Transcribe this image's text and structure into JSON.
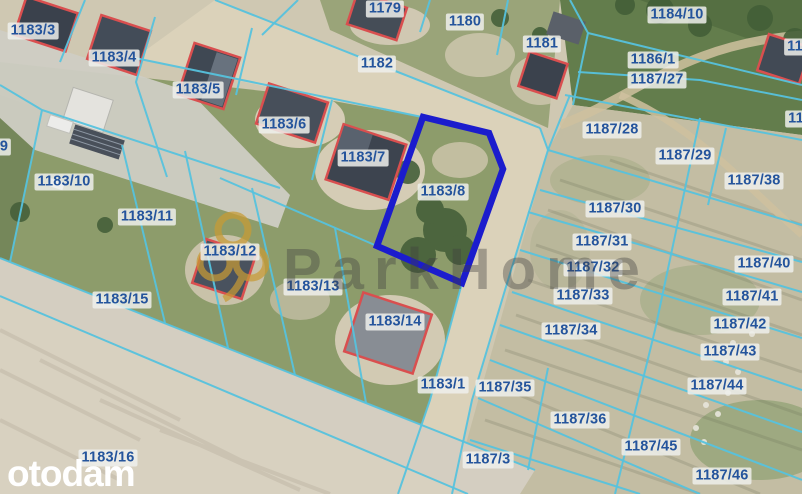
{
  "map": {
    "highlighted_parcel": "1183/8",
    "watermark": {
      "text": "ParkHome",
      "icon": "clover-rings-icon"
    },
    "brand_logo": "otodam",
    "colors": {
      "label_text": "#24549c",
      "boundary": "#56c2dd",
      "highlight": "#1b1ccd",
      "building_outline": "#d94f4f",
      "watermark_gold": "#c89b35",
      "watermark_text": "#3f3f3f",
      "logo_text": "#ffffff"
    },
    "parcel_labels": [
      {
        "text": "1183/3",
        "x": 33,
        "y": 31
      },
      {
        "text": "1183/4",
        "x": 114,
        "y": 58
      },
      {
        "text": "1183/5",
        "x": 198,
        "y": 90
      },
      {
        "text": "1179",
        "x": 385,
        "y": 9
      },
      {
        "text": "1180",
        "x": 465,
        "y": 22
      },
      {
        "text": "1182",
        "x": 377,
        "y": 64
      },
      {
        "text": "1181",
        "x": 542,
        "y": 44
      },
      {
        "text": "1183/6",
        "x": 284,
        "y": 125
      },
      {
        "text": "1183/7",
        "x": 363,
        "y": 158
      },
      {
        "text": "1183/8",
        "x": 443,
        "y": 192
      },
      {
        "text": "1184/10",
        "x": 677,
        "y": 15
      },
      {
        "text": "1186/1",
        "x": 653,
        "y": 60
      },
      {
        "text": "1187/27",
        "x": 657,
        "y": 80
      },
      {
        "text": "1187/28",
        "x": 612,
        "y": 130
      },
      {
        "text": "1187/29",
        "x": 685,
        "y": 156
      },
      {
        "text": "1187/38",
        "x": 754,
        "y": 181
      },
      {
        "text": "1187/30",
        "x": 615,
        "y": 209
      },
      {
        "text": "1187/31",
        "x": 602,
        "y": 242
      },
      {
        "text": "1187/32",
        "x": 593,
        "y": 268
      },
      {
        "text": "1187/33",
        "x": 583,
        "y": 296
      },
      {
        "text": "1187/40",
        "x": 764,
        "y": 264
      },
      {
        "text": "1187/41",
        "x": 752,
        "y": 297
      },
      {
        "text": "1187/42",
        "x": 740,
        "y": 325
      },
      {
        "text": "1187/34",
        "x": 571,
        "y": 331
      },
      {
        "text": "1187/43",
        "x": 730,
        "y": 352
      },
      {
        "text": "1187/44",
        "x": 717,
        "y": 386
      },
      {
        "text": "1187/36",
        "x": 580,
        "y": 420
      },
      {
        "text": "1187/45",
        "x": 651,
        "y": 447
      },
      {
        "text": "1187/46",
        "x": 722,
        "y": 476
      },
      {
        "text": "1187/35",
        "x": 505,
        "y": 388
      },
      {
        "text": "1183/1",
        "x": 443,
        "y": 385
      },
      {
        "text": "1187/3",
        "x": 488,
        "y": 460
      },
      {
        "text": "1183/14",
        "x": 395,
        "y": 322
      },
      {
        "text": "1183/13",
        "x": 313,
        "y": 287
      },
      {
        "text": "1183/12",
        "x": 230,
        "y": 252
      },
      {
        "text": "1183/11",
        "x": 147,
        "y": 217
      },
      {
        "text": "1183/10",
        "x": 64,
        "y": 182
      },
      {
        "text": "1183/15",
        "x": 122,
        "y": 300
      },
      {
        "text": "1183/16",
        "x": 108,
        "y": 458
      },
      {
        "text": "9",
        "x": 4,
        "y": 147
      },
      {
        "text": "11",
        "x": 795,
        "y": 47
      },
      {
        "text": "11",
        "x": 796,
        "y": 119
      }
    ]
  }
}
